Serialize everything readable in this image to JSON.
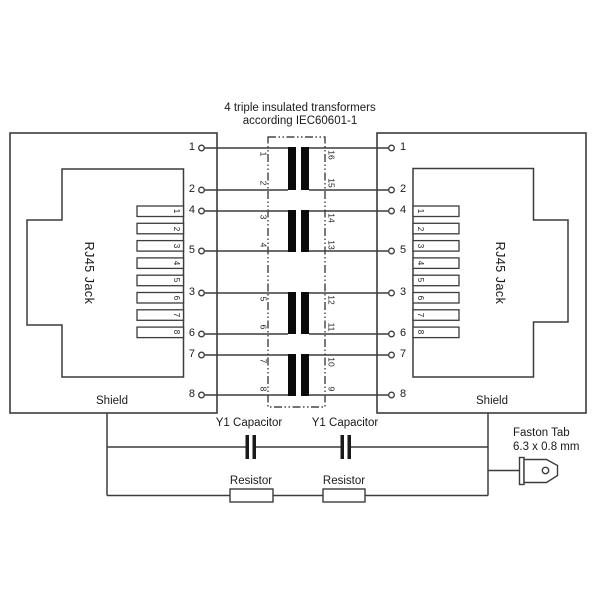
{
  "title": {
    "line1": "4 triple insulated transformers",
    "line2": "according IEC60601-1"
  },
  "jacks": {
    "left": {
      "label": "RJ45 Jack",
      "shield_label": "Shield",
      "pin_numbers": [
        "1",
        "2",
        "3",
        "4",
        "5",
        "6",
        "7",
        "8"
      ]
    },
    "right": {
      "label": "RJ45 Jack",
      "shield_label": "Shield",
      "pin_numbers": [
        "1",
        "2",
        "3",
        "4",
        "5",
        "6",
        "7",
        "8"
      ]
    }
  },
  "wire_rows": {
    "left_labels": [
      "1",
      "2",
      "4",
      "5",
      "3",
      "6",
      "7",
      "8"
    ],
    "right_labels": [
      "1",
      "2",
      "4",
      "5",
      "3",
      "6",
      "7",
      "8"
    ]
  },
  "transformers": {
    "left_pin_labels": [
      "1",
      "2",
      "3",
      "4",
      "5",
      "6",
      "7",
      "8"
    ],
    "right_pin_labels": [
      "16",
      "15",
      "14",
      "13",
      "12",
      "11",
      "10",
      "9"
    ]
  },
  "capacitors": {
    "label1": "Y1 Capacitor",
    "label2": "Y1 Capacitor"
  },
  "resistors": {
    "label1": "Resistor",
    "label2": "Resistor"
  },
  "faston": {
    "line1": "Faston Tab",
    "line2": "6.3 x 0.8 mm"
  },
  "colors": {
    "ink": "#3c3c3c",
    "core_bar": "#0a0a0a",
    "background": "#ffffff"
  }
}
